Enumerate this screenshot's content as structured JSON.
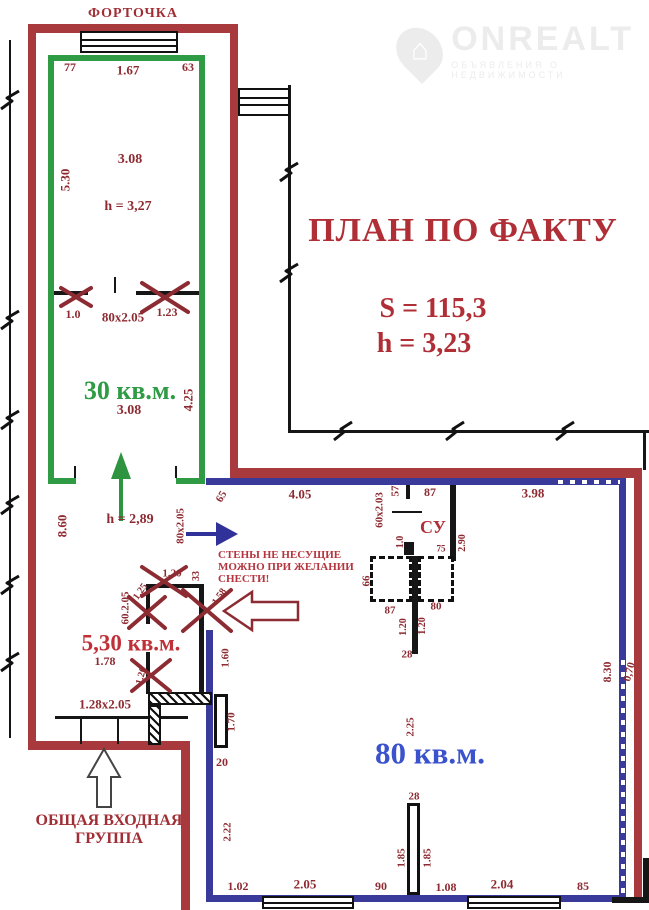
{
  "watermark": {
    "brand": "ONREALT",
    "subtext": "ОБЪЯВЛЕНИЯ О НЕДВИЖИМОСТИ"
  },
  "title": {
    "line1": "ПЛАН ПО ФАКТУ",
    "s_value": "S = 115,3",
    "h_value": "h = 3,23"
  },
  "vent_label": "ФОРТОЧКА",
  "warning": {
    "line1": "СТЕНЫ НЕ НЕСУЩИЕ",
    "line2": "МОЖНО ПРИ ЖЕЛАНИИ",
    "line3": "СНЕСТИ!"
  },
  "entrance": {
    "line1": "ОБЩАЯ ВХОДНАЯ",
    "line2": "ГРУППА"
  },
  "rooms": {
    "room30": {
      "area": "30 кв.м."
    },
    "room530": {
      "area": "5,30 кв.м."
    },
    "room80": {
      "area": "80 кв.м."
    },
    "su": {
      "label": "СУ"
    }
  },
  "colors": {
    "wall_red": "#a8393d",
    "wall_green": "#2f9b44",
    "wall_blue": "#3a3a9b",
    "text_red": "#8e2b32",
    "text_blue": "#3a52cc",
    "title_red": "#b02f36"
  },
  "dimensions": [
    {
      "t": "77",
      "x": 70,
      "y": 67,
      "r": 0,
      "s": 12
    },
    {
      "t": "1.67",
      "x": 128,
      "y": 70,
      "r": 0,
      "s": 13
    },
    {
      "t": "63",
      "x": 188,
      "y": 67,
      "r": 0,
      "s": 12
    },
    {
      "t": "5.30",
      "x": 65,
      "y": 180,
      "r": -90,
      "s": 13
    },
    {
      "t": "3.08",
      "x": 130,
      "y": 160,
      "r": 0,
      "s": 14
    },
    {
      "t": "h = 3,27",
      "x": 128,
      "y": 207,
      "r": 0,
      "s": 14
    },
    {
      "t": "1.0",
      "x": 73,
      "y": 314,
      "r": 0,
      "s": 12
    },
    {
      "t": "80x2.05",
      "x": 123,
      "y": 317,
      "r": 0,
      "s": 13
    },
    {
      "t": "1.23",
      "x": 167,
      "y": 312,
      "r": 0,
      "s": 12
    },
    {
      "t": "3.08",
      "x": 129,
      "y": 411,
      "r": 0,
      "s": 14
    },
    {
      "t": "4.25",
      "x": 188,
      "y": 400,
      "r": -90,
      "s": 13
    },
    {
      "t": "h = 2,89",
      "x": 130,
      "y": 520,
      "r": 0,
      "s": 14
    },
    {
      "t": "8.60",
      "x": 62,
      "y": 526,
      "r": -90,
      "s": 13
    },
    {
      "t": "65",
      "x": 222,
      "y": 497,
      "r": -60,
      "s": 11
    },
    {
      "t": "4.05",
      "x": 300,
      "y": 494,
      "r": 0,
      "s": 13
    },
    {
      "t": "60x2.03",
      "x": 380,
      "y": 510,
      "r": -90,
      "s": 11
    },
    {
      "t": "57",
      "x": 396,
      "y": 491,
      "r": -90,
      "s": 11
    },
    {
      "t": "87",
      "x": 430,
      "y": 492,
      "r": 0,
      "s": 12
    },
    {
      "t": "3.98",
      "x": 533,
      "y": 493,
      "r": 0,
      "s": 13
    },
    {
      "t": "1.0",
      "x": 401,
      "y": 542,
      "r": -90,
      "s": 10
    },
    {
      "t": "75",
      "x": 441,
      "y": 549,
      "r": 0,
      "s": 9
    },
    {
      "t": "2.90",
      "x": 463,
      "y": 543,
      "r": -90,
      "s": 10
    },
    {
      "t": "66",
      "x": 367,
      "y": 581,
      "r": -90,
      "s": 11
    },
    {
      "t": "87",
      "x": 390,
      "y": 611,
      "r": 0,
      "s": 11
    },
    {
      "t": "80",
      "x": 436,
      "y": 607,
      "r": 0,
      "s": 11
    },
    {
      "t": "1.20",
      "x": 404,
      "y": 627,
      "r": -90,
      "s": 10
    },
    {
      "t": "1.20",
      "x": 423,
      "y": 626,
      "r": -90,
      "s": 10
    },
    {
      "t": "28",
      "x": 407,
      "y": 655,
      "r": 0,
      "s": 11
    },
    {
      "t": "80x2.05",
      "x": 181,
      "y": 526,
      "r": -90,
      "s": 11
    },
    {
      "t": "1.20",
      "x": 172,
      "y": 574,
      "r": 0,
      "s": 11
    },
    {
      "t": "33",
      "x": 197,
      "y": 576,
      "r": -90,
      "s": 10
    },
    {
      "t": "1.25",
      "x": 141,
      "y": 592,
      "r": -55,
      "s": 10
    },
    {
      "t": "60.2.05",
      "x": 126,
      "y": 608,
      "r": -90,
      "s": 11
    },
    {
      "t": "1.58",
      "x": 220,
      "y": 597,
      "r": -55,
      "s": 10
    },
    {
      "t": "1.78",
      "x": 105,
      "y": 661,
      "r": 0,
      "s": 12
    },
    {
      "t": "1.26",
      "x": 142,
      "y": 676,
      "r": -75,
      "s": 10
    },
    {
      "t": "1.60",
      "x": 226,
      "y": 658,
      "r": -90,
      "s": 11
    },
    {
      "t": "1.28x2.05",
      "x": 105,
      "y": 704,
      "r": 0,
      "s": 13
    },
    {
      "t": "1.70",
      "x": 232,
      "y": 722,
      "r": -90,
      "s": 11
    },
    {
      "t": "20",
      "x": 222,
      "y": 762,
      "r": 0,
      "s": 12
    },
    {
      "t": "2.25",
      "x": 411,
      "y": 727,
      "r": -90,
      "s": 11
    },
    {
      "t": "8.30",
      "x": 607,
      "y": 672,
      "r": -90,
      "s": 12
    },
    {
      "t": "0,70",
      "x": 630,
      "y": 672,
      "r": -75,
      "s": 11
    },
    {
      "t": "28",
      "x": 414,
      "y": 797,
      "r": 0,
      "s": 11
    },
    {
      "t": "1.85",
      "x": 402,
      "y": 858,
      "r": -90,
      "s": 11
    },
    {
      "t": "1.85",
      "x": 428,
      "y": 858,
      "r": -90,
      "s": 11
    },
    {
      "t": "2.22",
      "x": 228,
      "y": 832,
      "r": -90,
      "s": 11
    },
    {
      "t": "1.02",
      "x": 238,
      "y": 886,
      "r": 0,
      "s": 12
    },
    {
      "t": "2.05",
      "x": 305,
      "y": 884,
      "r": 0,
      "s": 13
    },
    {
      "t": "90",
      "x": 381,
      "y": 886,
      "r": 0,
      "s": 12
    },
    {
      "t": "1.08",
      "x": 446,
      "y": 887,
      "r": 0,
      "s": 12
    },
    {
      "t": "2.04",
      "x": 502,
      "y": 884,
      "r": 0,
      "s": 13
    },
    {
      "t": "85",
      "x": 583,
      "y": 886,
      "r": 0,
      "s": 12
    }
  ]
}
